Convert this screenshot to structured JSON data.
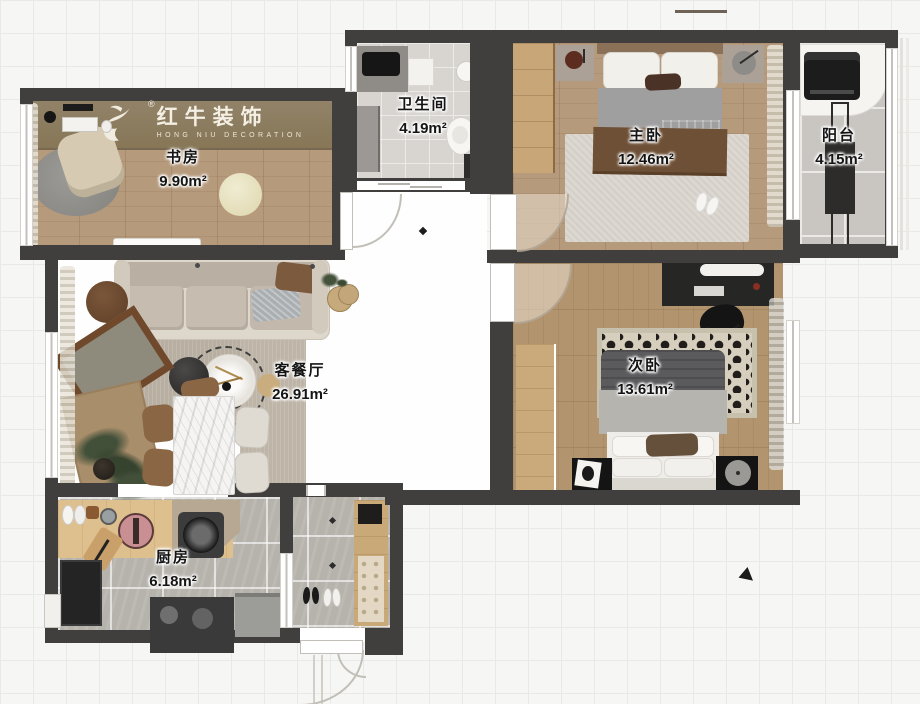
{
  "logo": {
    "brand": "红牛装饰",
    "brand_sub": "HONG NIU DECORATION",
    "registered": "®"
  },
  "rooms": [
    {
      "id": "study",
      "name": "书房",
      "area": "9.90m²"
    },
    {
      "id": "bathroom",
      "name": "卫生间",
      "area": "4.19m²"
    },
    {
      "id": "master",
      "name": "主卧",
      "area": "12.46m²"
    },
    {
      "id": "balcony",
      "name": "阳台",
      "area": "4.15m²"
    },
    {
      "id": "living",
      "name": "客餐厅",
      "area": "26.91m²"
    },
    {
      "id": "second",
      "name": "次卧",
      "area": "13.61m²"
    },
    {
      "id": "kitchen",
      "name": "厨房",
      "area": "6.18m²"
    }
  ],
  "colors": {
    "wall": "#403f3e",
    "wood_floor": "#b69a7c",
    "tile_gray": "#b6b2ac",
    "tile_bath": "#d8d5d1",
    "logo_band": "#8d7d61",
    "background": "#f6f6f4"
  }
}
